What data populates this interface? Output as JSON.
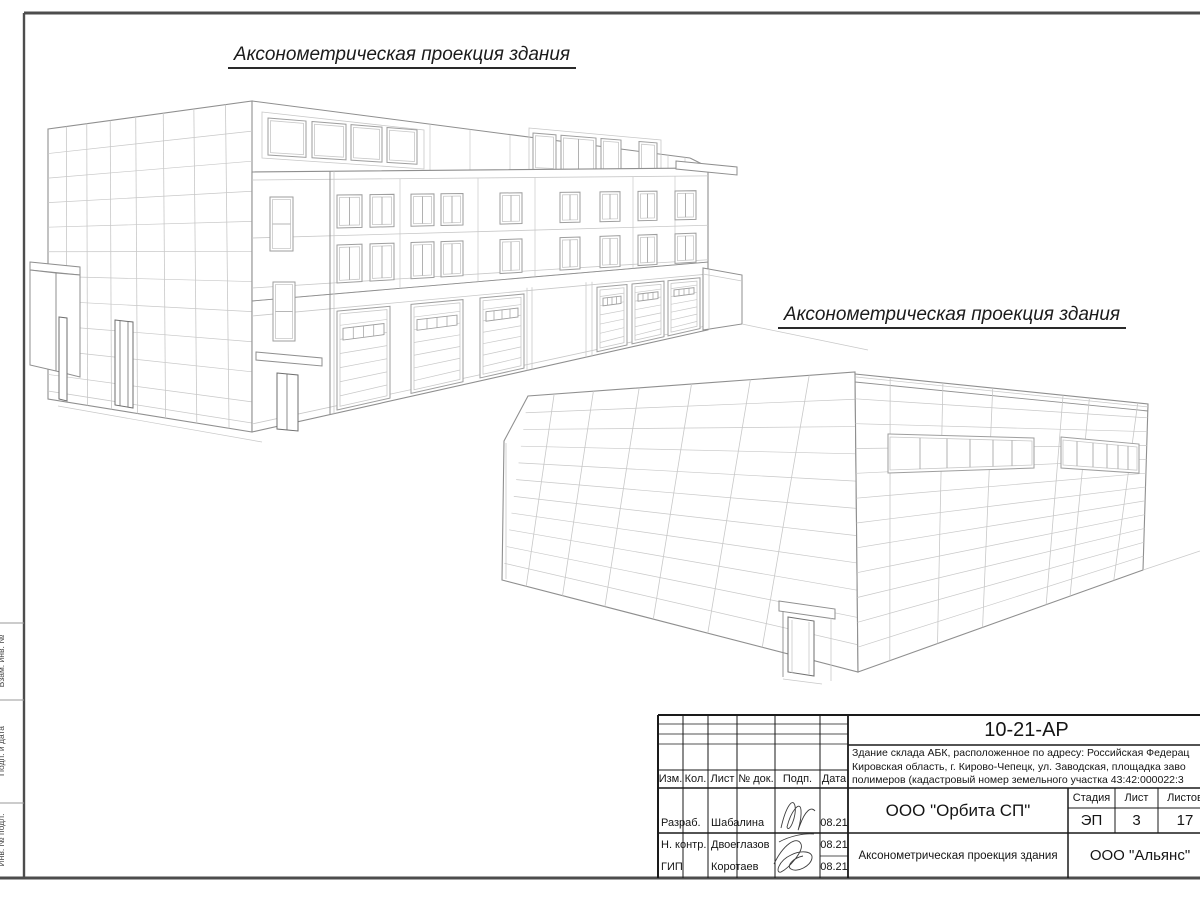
{
  "sheet": {
    "title_1": "Аксонометрическая проекция здания",
    "title_2": "Аксонометрическая проекция здания",
    "margin_labels": [
      "Взам. инв. №",
      "Подп. и дата",
      "Инв. № подл."
    ]
  },
  "title_block": {
    "doc_number": "10-21-АР",
    "description_lines": [
      "Здание склада АБК, расположенное по адресу: Российская Федерац",
      "Кировская область, г. Кирово-Чепецк, ул. Заводская, площадка заво",
      "полимеров (кадастровый номер земельного участка 43:42:000022:3"
    ],
    "rev_headers": [
      "Изм.",
      "Кол.",
      "Лист",
      "№ док.",
      "Подп.",
      "Дата"
    ],
    "roles": [
      {
        "role": "Разраб.",
        "name": "Шабалина",
        "date": "08.21"
      },
      {
        "role": "Н. контр.",
        "name": "Двоеглазов",
        "date": "08.21"
      },
      {
        "role": "ГИП",
        "name": "Коротаев",
        "date": "08.21"
      }
    ],
    "company": "ООО \"Орбита СП\"",
    "stage_label": "Стадия",
    "sheet_label": "Лист",
    "sheets_label": "Листов",
    "stage": "ЭП",
    "sheet_no": "3",
    "sheets_total": "17",
    "drawing_title": "Аксонометрическая проекция здания",
    "contractor": "ООО \"Альянс\""
  }
}
